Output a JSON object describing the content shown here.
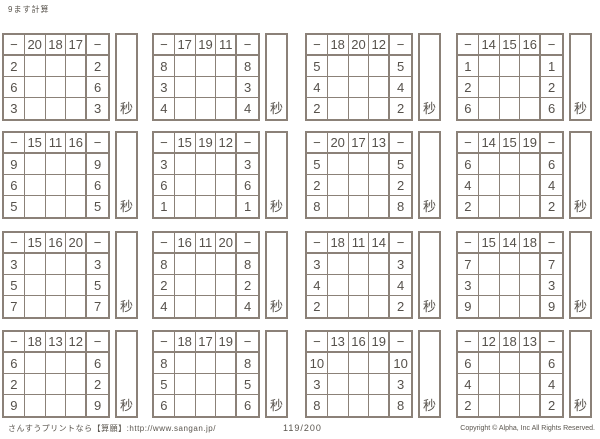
{
  "page": {
    "title": "9ます計算",
    "background_color": "#ffffff",
    "border_color": "#8b8178",
    "text_color": "#56514b"
  },
  "operator": "−",
  "timer": {
    "label": "秒"
  },
  "puzzles": [
    {
      "top": [
        20,
        18,
        17
      ],
      "left": [
        2,
        6,
        3
      ]
    },
    {
      "top": [
        17,
        19,
        11
      ],
      "left": [
        8,
        3,
        4
      ]
    },
    {
      "top": [
        18,
        20,
        12
      ],
      "left": [
        5,
        4,
        2
      ]
    },
    {
      "top": [
        14,
        15,
        16
      ],
      "left": [
        1,
        2,
        6
      ]
    },
    {
      "top": [
        15,
        11,
        16
      ],
      "left": [
        9,
        6,
        5
      ]
    },
    {
      "top": [
        15,
        19,
        12
      ],
      "left": [
        3,
        6,
        1
      ]
    },
    {
      "top": [
        20,
        17,
        13
      ],
      "left": [
        5,
        2,
        8
      ]
    },
    {
      "top": [
        14,
        15,
        19
      ],
      "left": [
        6,
        4,
        2
      ]
    },
    {
      "top": [
        15,
        16,
        20
      ],
      "left": [
        3,
        5,
        7
      ]
    },
    {
      "top": [
        16,
        11,
        20
      ],
      "left": [
        8,
        2,
        4
      ]
    },
    {
      "top": [
        18,
        11,
        14
      ],
      "left": [
        3,
        4,
        2
      ]
    },
    {
      "top": [
        15,
        14,
        18
      ],
      "left": [
        7,
        3,
        9
      ]
    },
    {
      "top": [
        18,
        13,
        12
      ],
      "left": [
        6,
        2,
        9
      ]
    },
    {
      "top": [
        18,
        17,
        19
      ],
      "left": [
        8,
        5,
        6
      ]
    },
    {
      "top": [
        13,
        16,
        19
      ],
      "left": [
        10,
        3,
        8
      ]
    },
    {
      "top": [
        12,
        18,
        13
      ],
      "left": [
        6,
        4,
        2
      ]
    }
  ],
  "layout": {
    "col_x": [
      2,
      152,
      305,
      456
    ],
    "row_y": [
      33,
      131,
      231,
      330
    ]
  },
  "footer": {
    "left": "さんすうプリントなら【算願】:http://www.sangan.jp/",
    "center": "119/200",
    "right": "Copyright © Alpha, Inc All Rights Reserved."
  }
}
